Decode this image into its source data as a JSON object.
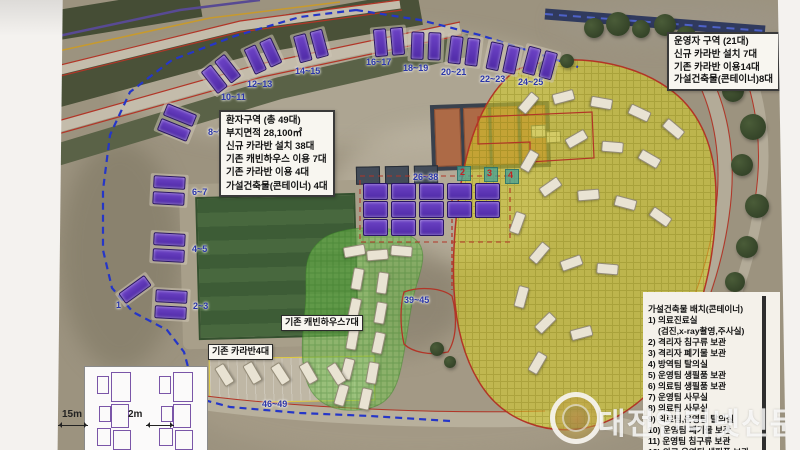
{
  "map": {
    "patient_box": {
      "lines": [
        "환자구역 (총 49대)",
        "부지면적 28,100㎡",
        "신규 카라반 설치 38대",
        "기존 캐빈하우스 이용 7대",
        "기존 카라반 이용 4대",
        "가설건축물(콘테이너) 4대"
      ]
    },
    "operator_box": {
      "lines": [
        "운영자 구역 (21대)",
        "신규 카라반 설치 7대",
        "기존 카라반 이용14대",
        "가설건축물(콘테이너)8대"
      ]
    },
    "container_list": {
      "title": "가설건축물 배치(콘테이너)",
      "items": [
        "1) 의료진료실",
        "(검진,x-ray촬영,주사실)",
        "2) 격리자 침구류 보관",
        "3) 격리자 폐기물 보관",
        "4) 방역팀 탈의실",
        "5) 운영팀 생필품 보관",
        "6) 의료팀 생필품 보관",
        "7) 운영팀 사무실",
        "8) 의료팀 사무실",
        "9) 의료팀,운영팀 탈의실",
        "10) 운영팀 폐기물 보관",
        "11) 운영팀 침구류 보관",
        "12) 의료,운영팀 생필품 보관"
      ]
    },
    "cabin_house_label": "기존 캐빈하우스7대",
    "old_caravan_label": "기존 카라반4대",
    "bay_labels": [
      "1",
      "2~3",
      "4~5",
      "6~7",
      "8~9",
      "10~11",
      "12~13",
      "14~15",
      "16~17",
      "18~19",
      "20~21",
      "22~23",
      "24~25",
      "26~38",
      "39~45",
      "46~49"
    ],
    "court_numbers": [
      "2",
      "3",
      "4"
    ],
    "inset": {
      "dim_width": "15m",
      "dim_gap": "2m"
    }
  },
  "watermark": {
    "text": "대전인터넷신문"
  },
  "colors": {
    "boundary_blue": "#2536c8",
    "road_edge_red": "#b23527",
    "patient_zone_yellow": "#d6cd2a",
    "cabin_zone_green": "#76c852",
    "caravan_purple": "#5d34b8"
  }
}
